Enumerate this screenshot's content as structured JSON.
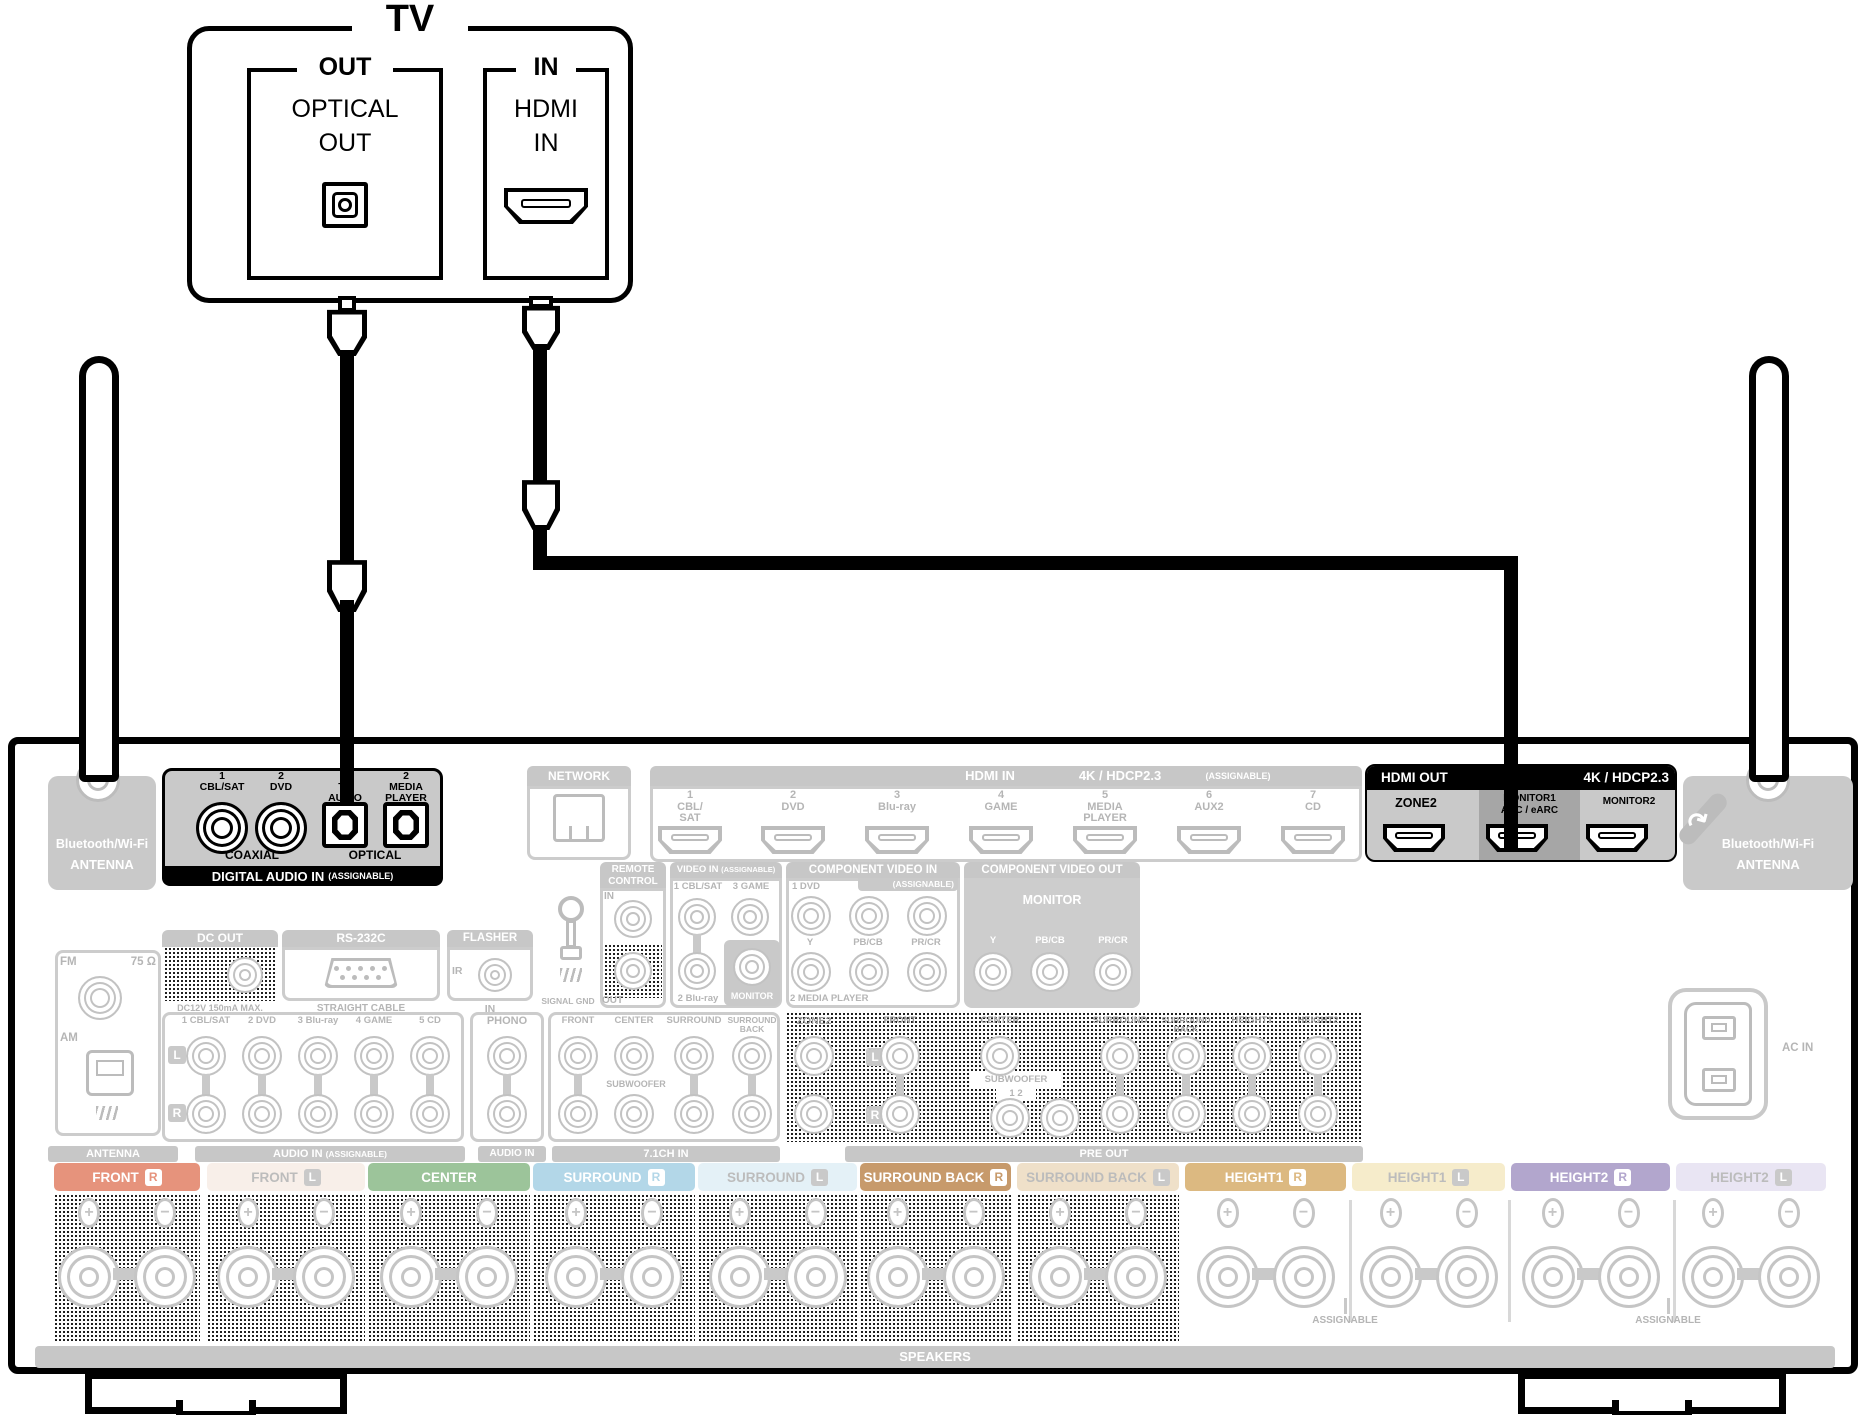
{
  "diagram": {
    "tv": {
      "title": "TV",
      "out_group": {
        "bracket": "OUT",
        "line1": "OPTICAL",
        "line2": "OUT"
      },
      "in_group": {
        "bracket": "IN",
        "line1": "HDMI",
        "line2": "IN"
      }
    },
    "receiver": {
      "antenna_left": {
        "line1": "Bluetooth/Wi-Fi",
        "line2": "ANTENNA"
      },
      "antenna_right": {
        "line1": "Bluetooth/Wi-Fi",
        "line2": "ANTENNA"
      },
      "digital_audio_in": {
        "title": "DIGITAL AUDIO IN",
        "title_note": "(ASSIGNABLE)",
        "group_coaxial": "COAXIAL",
        "group_optical": "OPTICAL",
        "jacks": [
          {
            "num": "1",
            "lines": [
              "CBL/SAT"
            ],
            "kind": "coaxial"
          },
          {
            "num": "2",
            "lines": [
              "DVD"
            ],
            "kind": "coaxial"
          },
          {
            "num": "1",
            "lines": [
              "TV",
              "AUDIO"
            ],
            "kind": "optical"
          },
          {
            "num": "2",
            "lines": [
              "MEDIA",
              "PLAYER"
            ],
            "kind": "optical"
          }
        ]
      },
      "network": {
        "title": "NETWORK"
      },
      "hdmi_in": {
        "title": "HDMI IN",
        "spec": "4K / HDCP2.3",
        "note": "(ASSIGNABLE)",
        "ports": [
          {
            "num": "1",
            "lines": [
              "CBL/",
              "SAT"
            ]
          },
          {
            "num": "2",
            "lines": [
              "DVD"
            ]
          },
          {
            "num": "3",
            "lines": [
              "Blu-ray"
            ]
          },
          {
            "num": "4",
            "lines": [
              "GAME"
            ]
          },
          {
            "num": "5",
            "lines": [
              "MEDIA",
              "PLAYER"
            ]
          },
          {
            "num": "6",
            "lines": [
              "AUX2"
            ]
          },
          {
            "num": "7",
            "lines": [
              "CD"
            ]
          }
        ]
      },
      "hdmi_out": {
        "title": "HDMI OUT",
        "spec": "4K / HDCP2.3",
        "zone2": "ZONE2",
        "monitor1": "MONITOR1",
        "monitor1_sub": "ARC / eARC",
        "monitor2": "MONITOR2"
      },
      "remote_control": {
        "title1": "REMOTE",
        "title2": "CONTROL",
        "in": "IN",
        "out": "OUT"
      },
      "signal_gnd": "SIGNAL GND",
      "video_in": {
        "title": "VIDEO IN",
        "note": "(ASSIGNABLE)",
        "jack_1": "1 CBL/SAT",
        "jack_3": "3 GAME",
        "jack_2": "2 Blu-ray",
        "monitor": "MONITOR"
      },
      "component_video_in": {
        "title": "COMPONENT VIDEO IN",
        "note": "(ASSIGNABLE)",
        "jack_1": "1 DVD",
        "y": "Y",
        "pb": "PB/CB",
        "pr": "PR/CR",
        "jack_2": "2 MEDIA PLAYER"
      },
      "component_video_out": {
        "title": "COMPONENT VIDEO OUT",
        "monitor": "MONITOR",
        "y": "Y",
        "pb": "PB/CB",
        "pr": "PR/CR"
      },
      "tuner": {
        "fm": "FM",
        "ohm": "75 Ω",
        "am": "AM",
        "bar": "ANTENNA"
      },
      "dc_out": {
        "title": "DC OUT",
        "note": "DC12V 150mA MAX."
      },
      "rs232c": {
        "title": "RS-232C",
        "note": "STRAIGHT CABLE"
      },
      "flasher": {
        "title": "FLASHER",
        "ir": "IR",
        "in": "IN"
      },
      "audio_in": {
        "bar": "AUDIO IN",
        "bar_note": "(ASSIGNABLE)",
        "l": "L",
        "r": "R",
        "inputs": [
          "1 CBL/SAT",
          "2 DVD",
          "3 Blu-ray",
          "4 GAME",
          "5 CD"
        ],
        "phono": "PHONO",
        "phono_bar": "AUDIO IN"
      },
      "ch71_in": {
        "bar": "7.1CH IN",
        "subwoofer": "SUBWOOFER",
        "cols": [
          {
            "lines": [
              "FRONT"
            ]
          },
          {
            "lines": [
              "CENTER"
            ]
          },
          {
            "lines": [
              "SURROUND"
            ]
          },
          {
            "lines": [
              "SURROUND",
              "BACK"
            ]
          }
        ]
      },
      "pre_out": {
        "bar": "PRE OUT",
        "zone2": "ZONE2",
        "l": "L",
        "r": "R",
        "subwoofer": "SUBWOOFER",
        "sub_nums": "1 2",
        "cols": [
          {
            "lines": [
              "FRONT"
            ]
          },
          {
            "lines": [
              "CENTER"
            ]
          },
          {
            "lines": [
              "SURROUND"
            ]
          },
          {
            "lines": [
              "SURROUND",
              "BACK"
            ]
          },
          {
            "lines": [
              "HEIGHT1"
            ]
          },
          {
            "lines": [
              "HEIGHT2"
            ]
          }
        ]
      },
      "ac_in": "AC IN",
      "speakers": {
        "bar": "SPEAKERS",
        "assignable_1": "ASSIGNABLE",
        "assignable_2": "ASSIGNABLE",
        "sections": [
          {
            "label": "FRONT",
            "letter": "R",
            "bg": "#e6937c",
            "fg": "#ffffff",
            "dither": true
          },
          {
            "label": "FRONT",
            "letter": "L",
            "bg": "#f8efe9",
            "fg": "#bcbcbc",
            "dither": true
          },
          {
            "label": "CENTER",
            "letter": "",
            "bg": "#9cc49a",
            "fg": "#ffffff",
            "dither": true
          },
          {
            "label": "SURROUND",
            "letter": "R",
            "bg": "#b3d7e8",
            "fg": "#ffffff",
            "dither": true
          },
          {
            "label": "SURROUND",
            "letter": "L",
            "bg": "#e4f1f7",
            "fg": "#bcbcbc",
            "dither": true
          },
          {
            "label": "SURROUND BACK",
            "letter": "R",
            "bg": "#c79a6b",
            "fg": "#ffffff",
            "dither": true
          },
          {
            "label": "SURROUND BACK",
            "letter": "L",
            "bg": "#efe0c9",
            "fg": "#bcbcbc",
            "dither": true
          },
          {
            "label": "HEIGHT1",
            "letter": "R",
            "bg": "#dcb981",
            "fg": "#ffffff",
            "dither": false
          },
          {
            "label": "HEIGHT1",
            "letter": "L",
            "bg": "#f6eccb",
            "fg": "#bcbcbc",
            "dither": false
          },
          {
            "label": "HEIGHT2",
            "letter": "R",
            "bg": "#b2a6cd",
            "fg": "#ffffff",
            "dither": false
          },
          {
            "label": "HEIGHT2",
            "letter": "L",
            "bg": "#e9e5f3",
            "fg": "#bcbcbc",
            "dither": false
          }
        ]
      }
    }
  },
  "colors": {
    "highlight": "#000000",
    "grayed": "#bcbcbc",
    "panel_header": "#c7c7c7",
    "block_fill": "#c9c9c9",
    "monitor1_band": "#a6a6a6"
  }
}
